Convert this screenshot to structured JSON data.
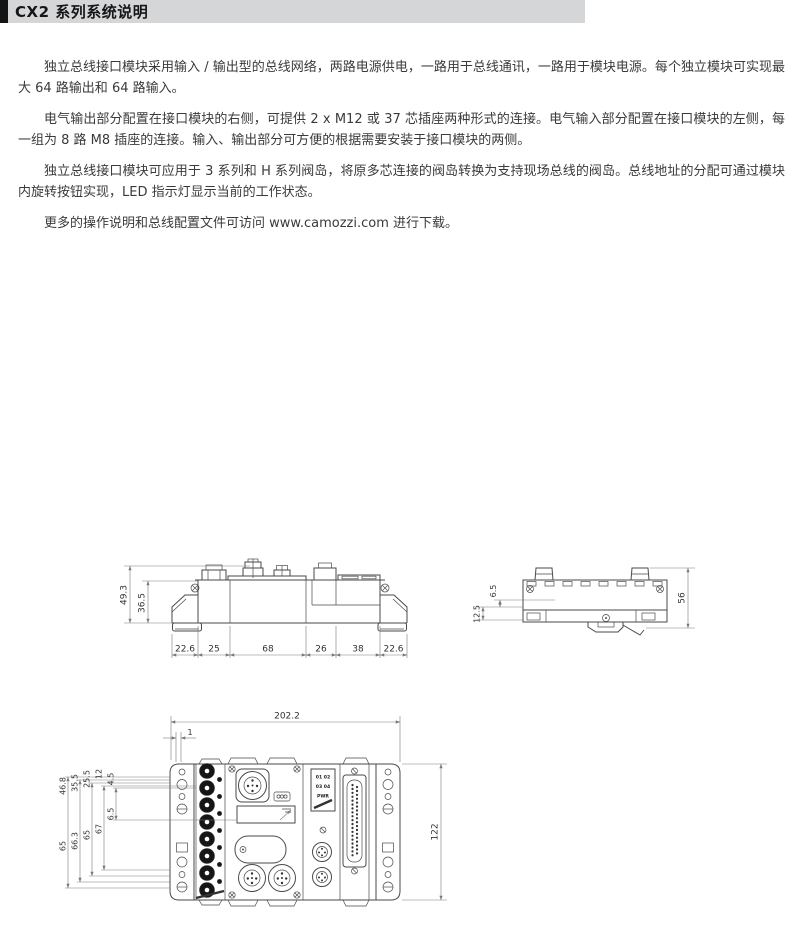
{
  "header": {
    "title": "CX2 系列系统说明"
  },
  "paragraphs": [
    "独立总线接口模块采用输入 / 输出型的总线网络，两路电源供电，一路用于总线通讯，一路用于模块电源。每个独立模块可实现最大 64 路输出和 64 路输入。",
    "电气输出部分配置在接口模块的右侧，可提供 2 x M12 或 37 芯插座两种形式的连接。电气输入部分配置在接口模块的左侧，每一组为 8 路 M8 插座的连接。输入、输出部分可方便的根据需要安装于接口模块的两侧。",
    "独立总线接口模块可应用于 3 系列和 H 系列阀岛，将原多芯连接的阀岛转换为支持现场总线的阀岛。总线地址的分配可通过模块内旋转按钮实现，LED 指示灯显示当前的工作状态。",
    "更多的操作说明和总线配置文件可访问 www.camozzi.com 进行下载。"
  ],
  "colors": {
    "header_bg": "#d5d6d7",
    "header_tab": "#141414",
    "line": "#4a4a4a",
    "dim": "#7a7a7a"
  },
  "drawings": {
    "side_view_left": {
      "height_dims": [
        "49.3",
        "36.5"
      ],
      "width_dims": [
        "22.6",
        "25",
        "68",
        "26",
        "38",
        "22.6"
      ]
    },
    "side_view_right": {
      "offset_dims": [
        "6.5",
        "12.5"
      ],
      "height_dim": "56"
    },
    "front_view": {
      "width_dim": "202.2",
      "plate_offset_dim": "1",
      "left_top_dims": [
        "46.8",
        "35.5",
        "25.5",
        "12",
        "4.5"
      ],
      "left_bottom_dims": [
        "65",
        "66.3",
        "65",
        "67",
        "6.5"
      ],
      "height_dim": "122",
      "led_rows": [
        "01 02",
        "03 04",
        "PWR"
      ]
    }
  }
}
